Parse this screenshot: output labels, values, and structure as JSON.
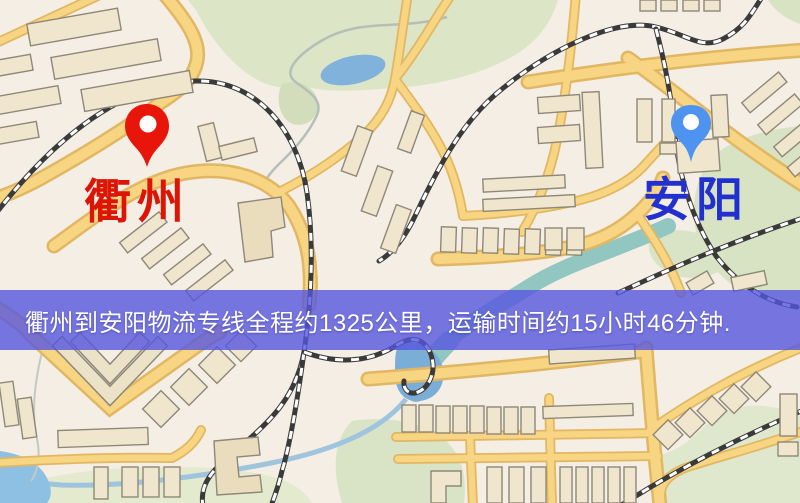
{
  "map": {
    "origin": {
      "name": "衢州",
      "pin_color": "#e8150b",
      "label_color": "#dd1505"
    },
    "destination": {
      "name": "安阳",
      "pin_color": "#4e93f0",
      "label_color": "#2230cf"
    },
    "palette": {
      "background": "#f4eee5",
      "road_fill": "#f8d57e",
      "road_casing": "#e3b75f",
      "railway_dark": "#3a3a3a",
      "building_fill": "#efe6cc",
      "park_green": "#dce5c5",
      "lake_blue": "#7fb2de",
      "river_teal": "#8fc8c0"
    }
  },
  "banner": {
    "text": "衢州到安阳物流专线全程约1325公里，运输时间约15小时46分钟.",
    "background": "#5656de",
    "text_color": "#ffffff"
  }
}
